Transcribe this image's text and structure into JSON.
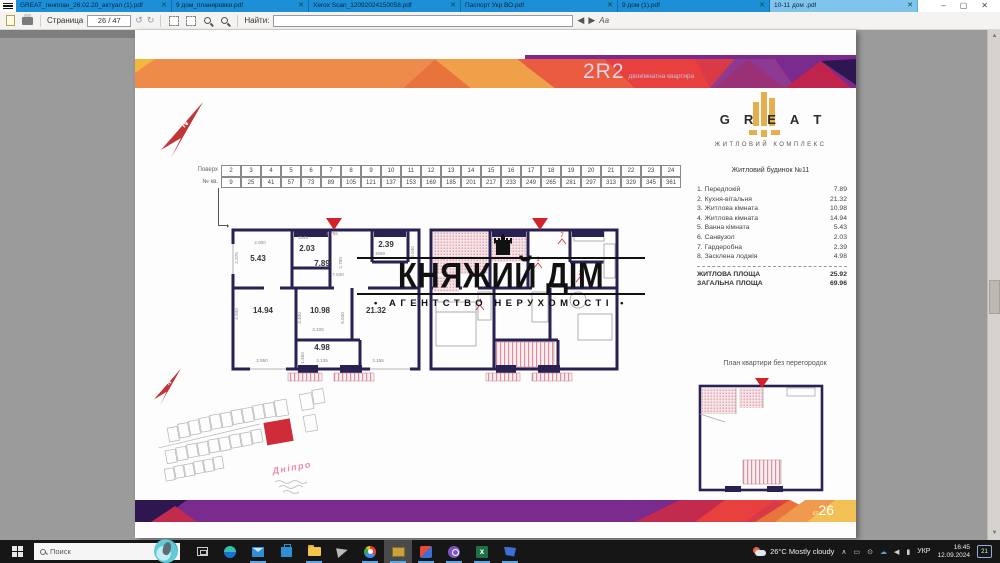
{
  "window": {
    "tabs": [
      {
        "label": "GREAT_генплан_26.02.20_актуал (1).pdf"
      },
      {
        "label": "9 дом_планировки.pdf"
      },
      {
        "label": "Xerox Scan_12092024150058.pdf"
      },
      {
        "label": "Паспорт Укр ВО.pdf"
      },
      {
        "label": "9 дом (1).pdf"
      },
      {
        "label": "10-11 дом .pdf"
      }
    ],
    "controls": {
      "minimize": "–",
      "maximize": "▢",
      "close": "✕"
    }
  },
  "toolbar": {
    "page_label": "Страница",
    "page_value": "26 / 47",
    "find_label": "Найти:",
    "find_value": ""
  },
  "doc": {
    "header": {
      "code": "2R2",
      "subtitle": "двокімнатна квартира"
    },
    "logo": {
      "letters": [
        "G",
        "R",
        "E",
        "A",
        "T"
      ],
      "tagline": "ЖИТЛОВИЙ КОМПЛЕКС"
    },
    "building_title": "Житловий будинок №11",
    "rooms": [
      {
        "num": "1.",
        "name": "Передпокій",
        "area": "7.89"
      },
      {
        "num": "2.",
        "name": "Кухня-вітальня",
        "area": "21.32"
      },
      {
        "num": "3.",
        "name": "Житлова кімната",
        "area": "10.98"
      },
      {
        "num": "4.",
        "name": "Житлова кімната",
        "area": "14.94"
      },
      {
        "num": "5.",
        "name": "Ванна кімната",
        "area": "5.43"
      },
      {
        "num": "6.",
        "name": "Санвузол",
        "area": "2.03"
      },
      {
        "num": "7.",
        "name": "Гардеробна",
        "area": "2.39"
      },
      {
        "num": "8.",
        "name": "Засклена лоджія",
        "area": "4.98"
      }
    ],
    "totals": [
      {
        "name": "ЖИТЛОВА ПЛОЩА",
        "area": "25.92"
      },
      {
        "name": "ЗАГАЛЬНА ПЛОЩА",
        "area": "69.96"
      }
    ],
    "floor_table": {
      "row1_label": "Поверх",
      "row2_label": "№ кв.",
      "floors": [
        "2",
        "3",
        "4",
        "5",
        "6",
        "7",
        "8",
        "9",
        "10",
        "11",
        "12",
        "13",
        "14",
        "15",
        "16",
        "17",
        "18",
        "19",
        "20",
        "21",
        "22",
        "23",
        "24"
      ],
      "apartments": [
        "9",
        "25",
        "41",
        "57",
        "73",
        "89",
        "105",
        "121",
        "137",
        "153",
        "169",
        "185",
        "201",
        "217",
        "233",
        "249",
        "265",
        "281",
        "297",
        "313",
        "329",
        "345",
        "361"
      ]
    },
    "plan": {
      "areas": {
        "bath": "5.43",
        "wc": "2.03",
        "wardrobe": "2.39",
        "hall": "7.89",
        "living": "14.94",
        "bedroom": "10.98",
        "kitchen": "21.32",
        "loggia": "4.98"
      },
      "dims": {
        "d2000": "2.000",
        "d1545": "1545",
        "d1755": "1.755",
        "d1560": "1560",
        "d2370": "2.370",
        "d2780": "2.780",
        "d7630": "7.630",
        "d3040": "3.040",
        "d4940": "4.940",
        "d3400": "3.400",
        "d3105": "3.105",
        "d5040": "5.040",
        "d1460": "1.460",
        "d2950": "2.950",
        "d3135": "3.135",
        "d3155": "3.155"
      },
      "markers": [
        "1",
        "2",
        "4",
        "7"
      ]
    },
    "watermark": {
      "title": "КНЯЖИЙ ДІМ",
      "subtitle": "• АГЕНТСТВО НЕРУХОМОСТІ •"
    },
    "site_plan": {
      "river": "Дніпро"
    },
    "open_plan_label": "План квартири без перегородок",
    "footer": {
      "page_prefix": "ст",
      "page_num": "26"
    }
  },
  "taskbar": {
    "search_placeholder": "Поиск",
    "app_icons": [
      "task-view",
      "edge",
      "mail",
      "store",
      "file-explorer",
      "viewer",
      "chrome",
      "pdf-reader-active",
      "photos",
      "viber",
      "excel",
      "remote-desktop"
    ],
    "weather": "26°C Mostly cloudy",
    "lang": "УКР",
    "time": "16:45",
    "date": "12.09.2024",
    "notif_badge": "21"
  },
  "colors": {
    "accent_purple": "#7b2b8d",
    "wall": "#2a2153",
    "red": "#c8232c",
    "gold": "#e5af4e",
    "tab_blue": "#1d8fd6",
    "tab_active": "#7fc4ec"
  }
}
